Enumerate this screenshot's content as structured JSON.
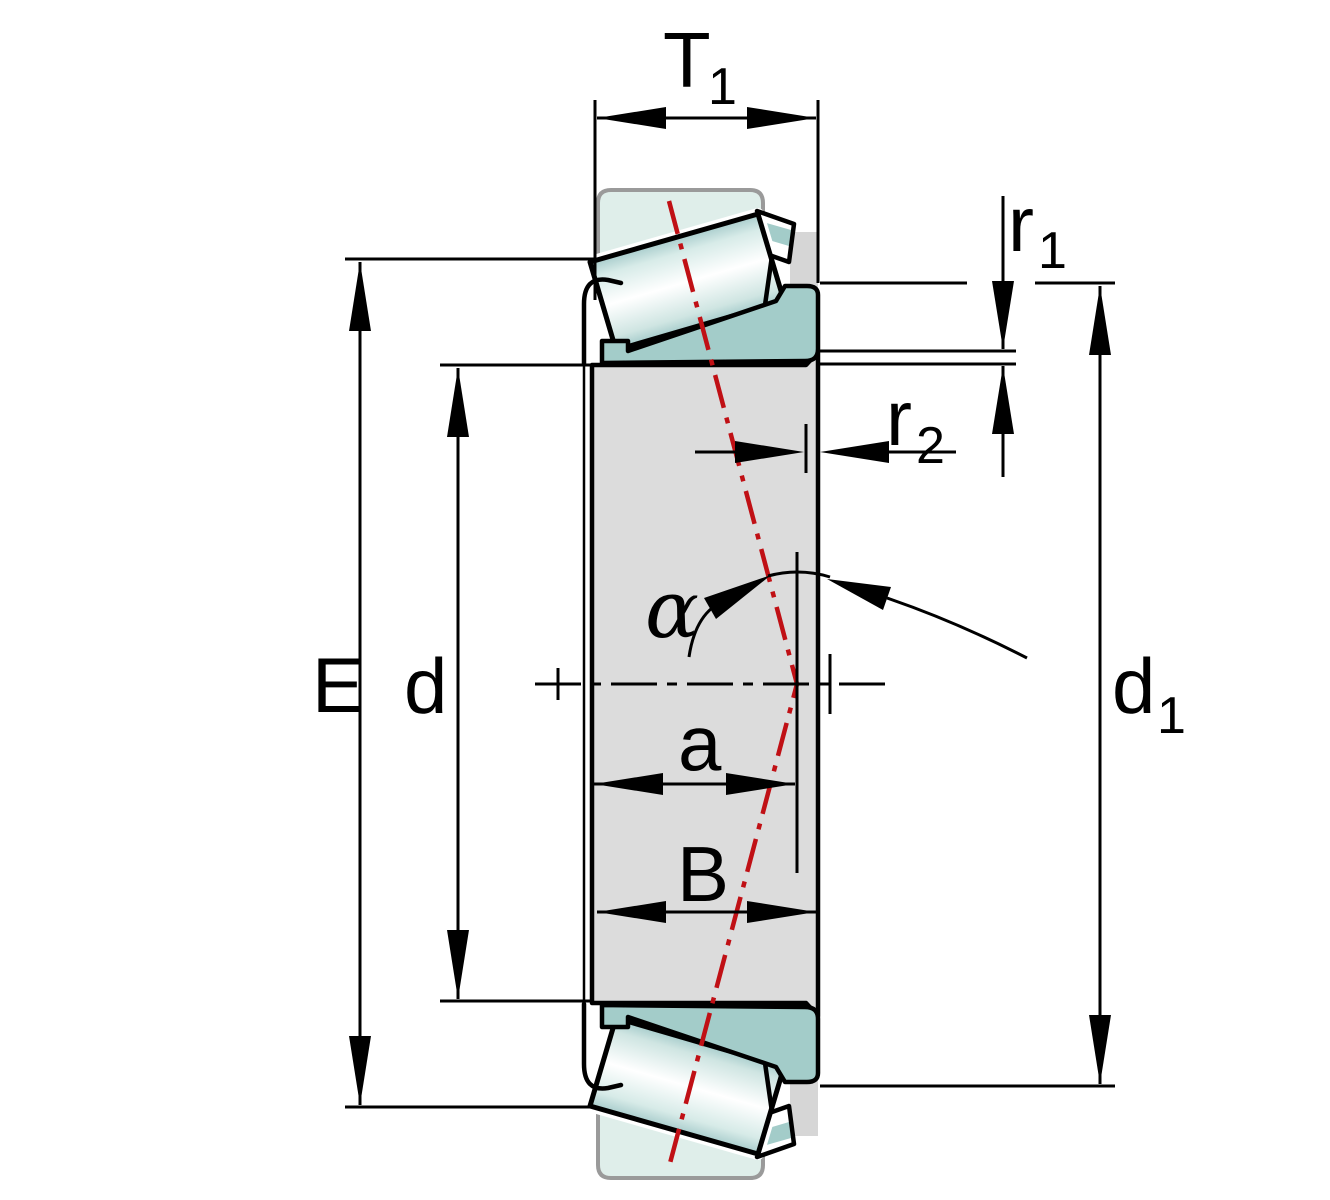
{
  "drawing": {
    "kind": "tapered-roller-bearing-dimension-drawing",
    "dimension_labels": {
      "T1": {
        "base": "T",
        "sub": "1"
      },
      "r1": {
        "base": "r",
        "sub": "1"
      },
      "r2": {
        "base": "r",
        "sub": "2"
      },
      "E": {
        "base": "E"
      },
      "d": {
        "base": "d"
      },
      "d1": {
        "base": "d",
        "sub": "1"
      },
      "a": {
        "base": "a"
      },
      "B": {
        "base": "B"
      },
      "alpha": {
        "base": "α"
      }
    },
    "colors": {
      "outer_ring": "#dfeeea",
      "outer_ring_border": "#9a9a9a",
      "inner_ring": "#a3ccc9",
      "section_fill": "#dcdcdc",
      "cage_fill": "#d6d6d6",
      "pressure_line_red": "#c01015",
      "outline": "#000000"
    }
  }
}
